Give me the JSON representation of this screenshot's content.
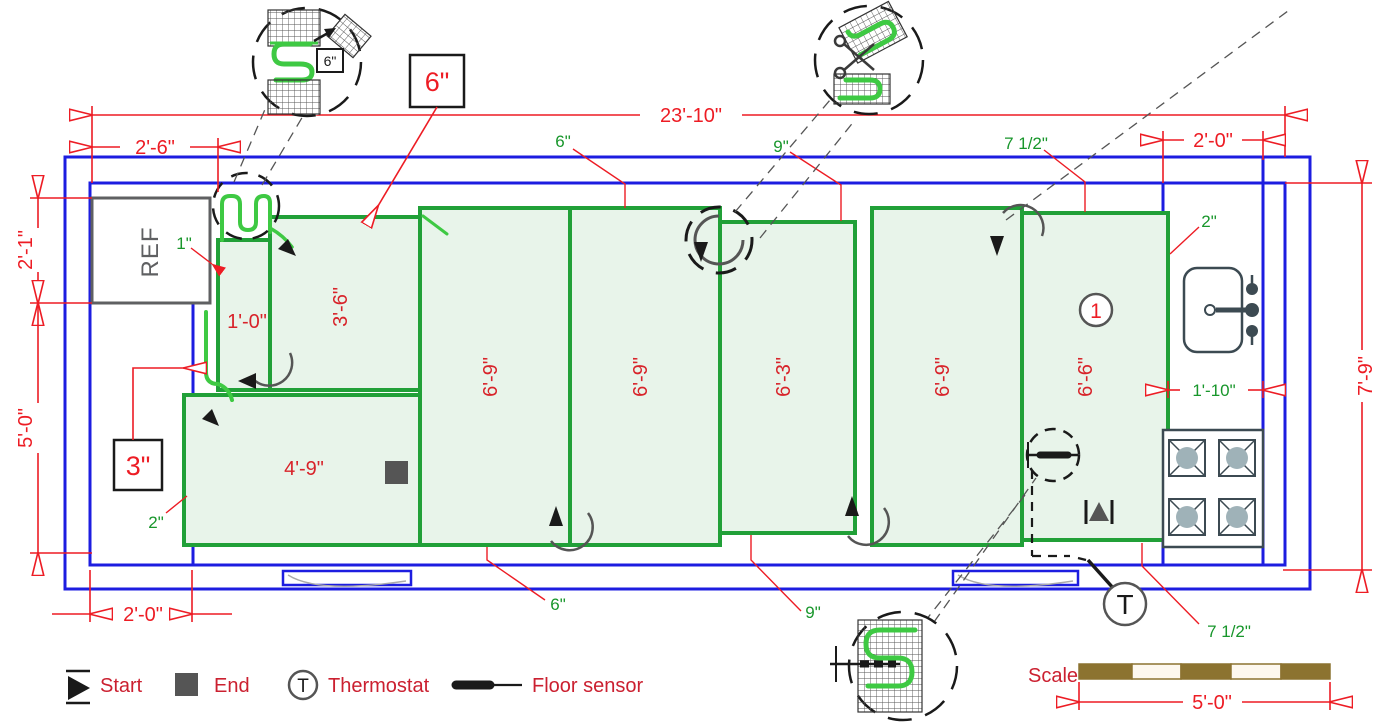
{
  "title": "Electric floor heating mat layout plan",
  "dims": {
    "total_width": "23'-10\"",
    "top_left": "2'-6\"",
    "top_right": "2'-0\"",
    "left_upper": "2'-1\"",
    "left_lower": "5'-0\"",
    "right_height": "7'-9\"",
    "bottom_left": "2'-0\"",
    "counter_width": "1'-10\""
  },
  "offsets": {
    "ref_gap": "1\"",
    "top_first": "6\"",
    "top_second": "9\"",
    "top_third": "7 1/2\"",
    "corner_right": "2\"",
    "left_bottom": "2\"",
    "bottom_first": "6\"",
    "bottom_second": "9\"",
    "bottom_third": "7 1/2\""
  },
  "callouts": {
    "spacing_large": "6\"",
    "spacing_small": "3\"",
    "detail_spacing": "6\"",
    "mat_number": "1"
  },
  "panels": [
    {
      "id": "A",
      "label": "1'-0\""
    },
    {
      "id": "B",
      "label": "3'-6\""
    },
    {
      "id": "H",
      "label": "4'-9\""
    },
    {
      "id": "C",
      "label": "6'-9\""
    },
    {
      "id": "D",
      "label": "6'-9\""
    },
    {
      "id": "E",
      "label": "6'-3\""
    },
    {
      "id": "F",
      "label": "6'-9\""
    },
    {
      "id": "G",
      "label": "6'-6\""
    }
  ],
  "appliances": {
    "ref": "REF"
  },
  "legend": {
    "start": "Start",
    "end": "End",
    "thermostat": "Thermostat",
    "floor_sensor": "Floor sensor",
    "t_letter": "T"
  },
  "scale": {
    "label": "Scale",
    "length": "5'-0\""
  },
  "colors": {
    "dimension_red": "#ed1c24",
    "wall_blue": "#1d1de0",
    "mat_border_green": "#21a038",
    "mat_fill_green": "#e8f4ea",
    "cable_green": "#3ec943",
    "offset_text_green": "#18962b",
    "appliance_gray": "#3c4a52",
    "scale_brown": "#8c7330",
    "icon_black": "#1a1a1a"
  }
}
